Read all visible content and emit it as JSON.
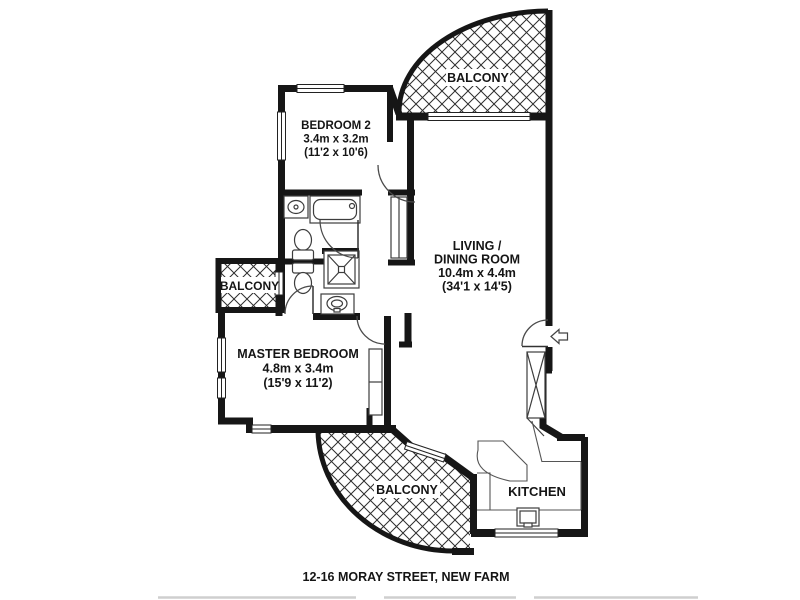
{
  "caption": "12-16 MORAY STREET, NEW FARM",
  "rooms": {
    "balcony_top": {
      "label": "BALCONY"
    },
    "bedroom2": {
      "label": "BEDROOM 2",
      "dim_metric": "3.4m x 3.2m",
      "dim_imperial": "(11'2 x 10'6)"
    },
    "living_dining": {
      "label_line1": "LIVING /",
      "label_line2": "DINING ROOM",
      "dim_metric": "10.4m x 4.4m",
      "dim_imperial": "(34'1 x 14'5)"
    },
    "balcony_left": {
      "label": "BALCONY"
    },
    "master_bedroom": {
      "label": "MASTER BEDROOM",
      "dim_metric": "4.8m x 3.4m",
      "dim_imperial": "(15'9 x 11'2)"
    },
    "balcony_bottom": {
      "label": "BALCONY"
    },
    "kitchen": {
      "label": "KITCHEN"
    }
  },
  "fixtures": [
    "bathtub",
    "vanity-basin-1",
    "toilet-1",
    "toilet-2",
    "shower",
    "vanity-basin-2",
    "kitchen-sink",
    "wardrobe",
    "hall-closet",
    "pantry-cabinet"
  ],
  "colors": {
    "wall": "#161616",
    "hatch": "#2e2e2e",
    "fixture_line": "#3d3d3d",
    "thin_line": "#555555",
    "text": "#151515",
    "background": "#ffffff",
    "faint_rule": "#cfcfcf"
  }
}
